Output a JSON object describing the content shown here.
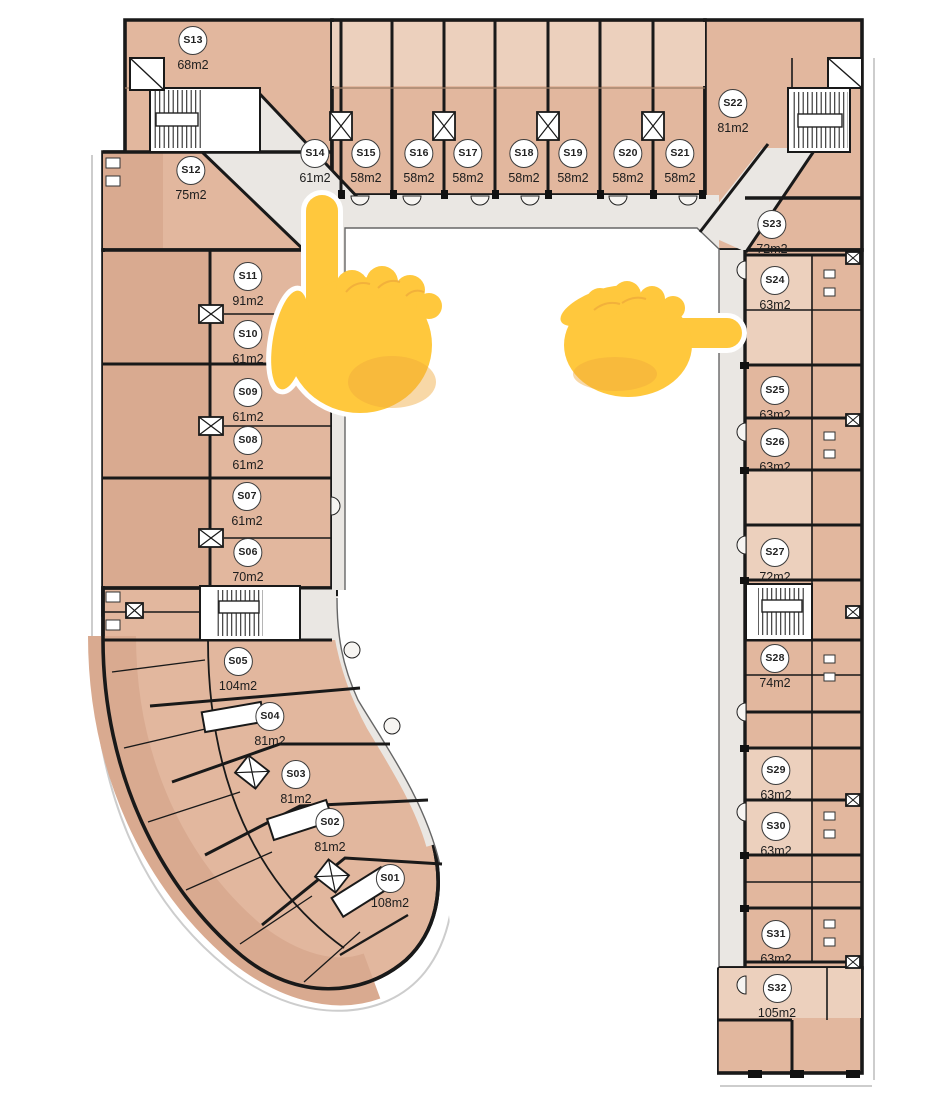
{
  "plan_title": "Residential floor plan with unit numbers and areas",
  "colors": {
    "wall": "#191919",
    "room_base": "#e2b79e",
    "room_light": "#ecd0bd",
    "room_dark": "#d9aa90",
    "corridor": "#eae7e3",
    "courtyard": "#ffffff",
    "hand_emoji": "#ffc83d",
    "hand_shadow": "#f0a83c"
  },
  "units": [
    {
      "id": "S01",
      "area": "108m2",
      "x": 390,
      "y": 878
    },
    {
      "id": "S02",
      "area": "81m2",
      "x": 330,
      "y": 822
    },
    {
      "id": "S03",
      "area": "81m2",
      "x": 296,
      "y": 774
    },
    {
      "id": "S04",
      "area": "81m2",
      "x": 270,
      "y": 716
    },
    {
      "id": "S05",
      "area": "104m2",
      "x": 238,
      "y": 661
    },
    {
      "id": "S06",
      "area": "70m2",
      "x": 248,
      "y": 552
    },
    {
      "id": "S07",
      "area": "61m2",
      "x": 247,
      "y": 496
    },
    {
      "id": "S08",
      "area": "61m2",
      "x": 248,
      "y": 440
    },
    {
      "id": "S09",
      "area": "61m2",
      "x": 248,
      "y": 392
    },
    {
      "id": "S10",
      "area": "61m2",
      "x": 248,
      "y": 334
    },
    {
      "id": "S11",
      "area": "91m2",
      "x": 248,
      "y": 276
    },
    {
      "id": "S12",
      "area": "75m2",
      "x": 191,
      "y": 170
    },
    {
      "id": "S13",
      "area": "68m2",
      "x": 193,
      "y": 40
    },
    {
      "id": "S14",
      "area": "61m2",
      "x": 315,
      "y": 153
    },
    {
      "id": "S15",
      "area": "58m2",
      "x": 366,
      "y": 153
    },
    {
      "id": "S16",
      "area": "58m2",
      "x": 419,
      "y": 153
    },
    {
      "id": "S17",
      "area": "58m2",
      "x": 468,
      "y": 153
    },
    {
      "id": "S18",
      "area": "58m2",
      "x": 524,
      "y": 153
    },
    {
      "id": "S19",
      "area": "58m2",
      "x": 573,
      "y": 153
    },
    {
      "id": "S20",
      "area": "58m2",
      "x": 628,
      "y": 153
    },
    {
      "id": "S21",
      "area": "58m2",
      "x": 680,
      "y": 153
    },
    {
      "id": "S22",
      "area": "81m2",
      "x": 733,
      "y": 103
    },
    {
      "id": "S23",
      "area": "72m2",
      "x": 772,
      "y": 224
    },
    {
      "id": "S24",
      "area": "63m2",
      "x": 775,
      "y": 280
    },
    {
      "id": "S25",
      "area": "63m2",
      "x": 775,
      "y": 390
    },
    {
      "id": "S26",
      "area": "63m2",
      "x": 775,
      "y": 442
    },
    {
      "id": "S27",
      "area": "72m2",
      "x": 775,
      "y": 552
    },
    {
      "id": "S28",
      "area": "74m2",
      "x": 775,
      "y": 658
    },
    {
      "id": "S29",
      "area": "63m2",
      "x": 776,
      "y": 770
    },
    {
      "id": "S30",
      "area": "63m2",
      "x": 776,
      "y": 826
    },
    {
      "id": "S31",
      "area": "63m2",
      "x": 776,
      "y": 934
    },
    {
      "id": "S32",
      "area": "105m2",
      "x": 777,
      "y": 988
    }
  ],
  "annotations": {
    "pointing_up_hand": {
      "emoji": "👆",
      "points_at": "S11"
    },
    "pointing_right_hand": {
      "emoji": "👉",
      "points_at": "S24"
    }
  }
}
